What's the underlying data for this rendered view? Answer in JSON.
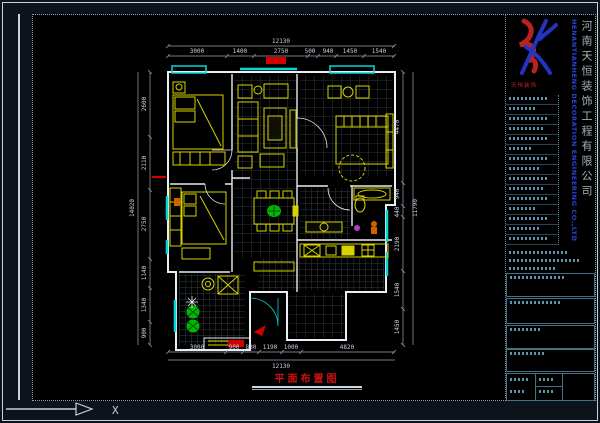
{
  "title_block": {
    "company_cn": "河南天恒装饰工程有限公司",
    "company_en": "HENANTIANHENG DECORATION ENGINEERING CO.,LTD",
    "logo_caption": "天恒装饰",
    "logo_colors": {
      "red": "#b82222",
      "blue": "#2433c0"
    }
  },
  "drawing": {
    "title": "平面布置图",
    "axis_label": "X",
    "colors": {
      "wall": "#e8eef2",
      "window": "#00d8d8",
      "furniture": "#d6d300",
      "plant": "#00b800",
      "accent_red": "#d40000",
      "dim_text": "#c7d0d9"
    }
  },
  "dims": {
    "top": {
      "total": "12130",
      "segments": [
        "3000",
        "1400",
        "2750",
        "500",
        "940",
        "1450",
        "1540"
      ]
    },
    "bottom": {
      "total": "12130",
      "segments": [
        "3000",
        "900",
        "830",
        "1190",
        "1000",
        "4820"
      ]
    },
    "left": {
      "total": "14020",
      "segments": [
        "2600",
        "2110",
        "2750",
        "1140",
        "1340",
        "900"
      ]
    },
    "right": {
      "total": "11790",
      "segments": [
        "4470",
        "940",
        "440",
        "2190",
        "1540",
        "1450"
      ]
    }
  }
}
